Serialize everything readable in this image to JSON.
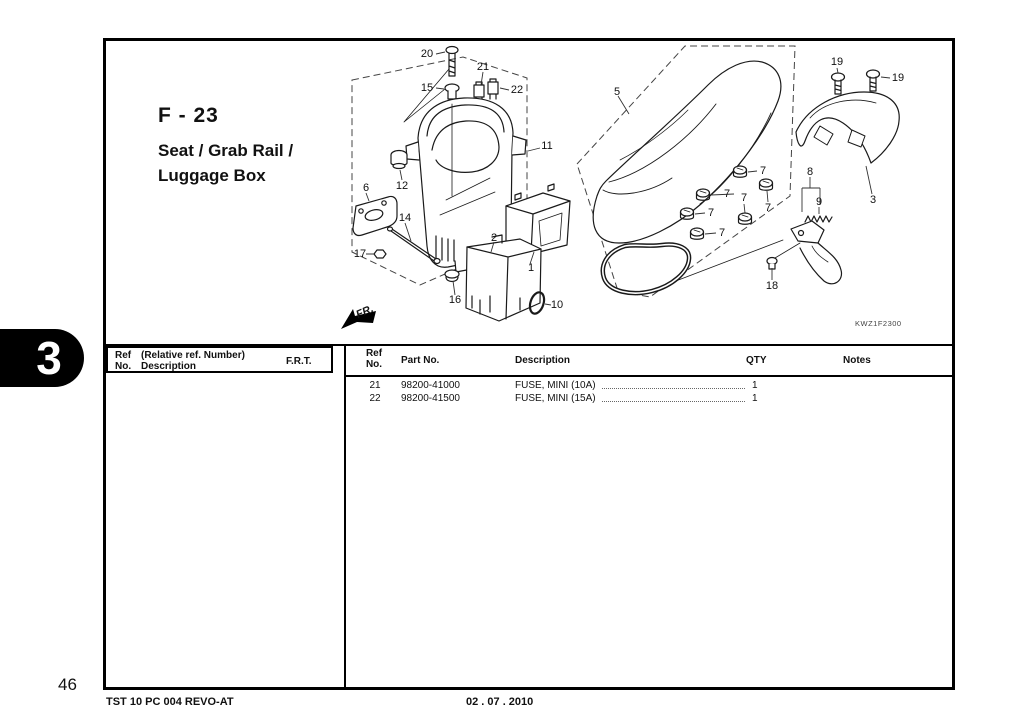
{
  "page": {
    "tab_number": "3",
    "page_number": "46",
    "footer_left": "TST 10 PC 004 REVO-AT",
    "footer_date": "02 . 07 . 2010",
    "ink_color": "#111111"
  },
  "title": {
    "section_code": "F - 23",
    "line1": "Seat / Grab Rail /",
    "line2": "Luggage Box"
  },
  "diagram": {
    "fr_label": "FR.",
    "diagram_code": "KWZ1F2300",
    "labels": [
      {
        "text": "20",
        "x": 427,
        "y": 54
      },
      {
        "text": "15",
        "x": 427,
        "y": 88
      },
      {
        "text": "21",
        "x": 483,
        "y": 67
      },
      {
        "text": "22",
        "x": 517,
        "y": 90
      },
      {
        "text": "11",
        "x": 547,
        "y": 146
      },
      {
        "text": "5",
        "x": 617,
        "y": 92
      },
      {
        "text": "12",
        "x": 402,
        "y": 186
      },
      {
        "text": "6",
        "x": 366,
        "y": 188
      },
      {
        "text": "14",
        "x": 405,
        "y": 218
      },
      {
        "text": "17",
        "x": 360,
        "y": 254
      },
      {
        "text": "2",
        "x": 494,
        "y": 238
      },
      {
        "text": "1",
        "x": 531,
        "y": 268
      },
      {
        "text": "16",
        "x": 455,
        "y": 300
      },
      {
        "text": "10",
        "x": 557,
        "y": 305
      },
      {
        "text": "7",
        "x": 763,
        "y": 171
      },
      {
        "text": "7",
        "x": 727,
        "y": 194
      },
      {
        "text": "7",
        "x": 768,
        "y": 208
      },
      {
        "text": "7",
        "x": 744,
        "y": 198
      },
      {
        "text": "7",
        "x": 711,
        "y": 213
      },
      {
        "text": "7",
        "x": 722,
        "y": 233
      },
      {
        "text": "8",
        "x": 810,
        "y": 172
      },
      {
        "text": "9",
        "x": 819,
        "y": 202
      },
      {
        "text": "3",
        "x": 873,
        "y": 200
      },
      {
        "text": "19",
        "x": 837,
        "y": 62
      },
      {
        "text": "19",
        "x": 898,
        "y": 78
      },
      {
        "text": "18",
        "x": 772,
        "y": 286
      }
    ]
  },
  "parts_table": {
    "left_header": {
      "ref": "Ref",
      "no": "No.",
      "relative": "(Relative ref. Number)",
      "description": "Description",
      "frt": "F.R.T."
    },
    "right_header": {
      "ref": "Ref",
      "no": "No.",
      "part_no": "Part No.",
      "description": "Description",
      "qty": "QTY",
      "notes": "Notes"
    },
    "rows": [
      {
        "ref_no": "21",
        "part_no": "98200-41000",
        "description": "FUSE, MINI (10A)",
        "qty": "1",
        "notes": ""
      },
      {
        "ref_no": "22",
        "part_no": "98200-41500",
        "description": "FUSE, MINI (15A)",
        "qty": "1",
        "notes": ""
      }
    ]
  }
}
